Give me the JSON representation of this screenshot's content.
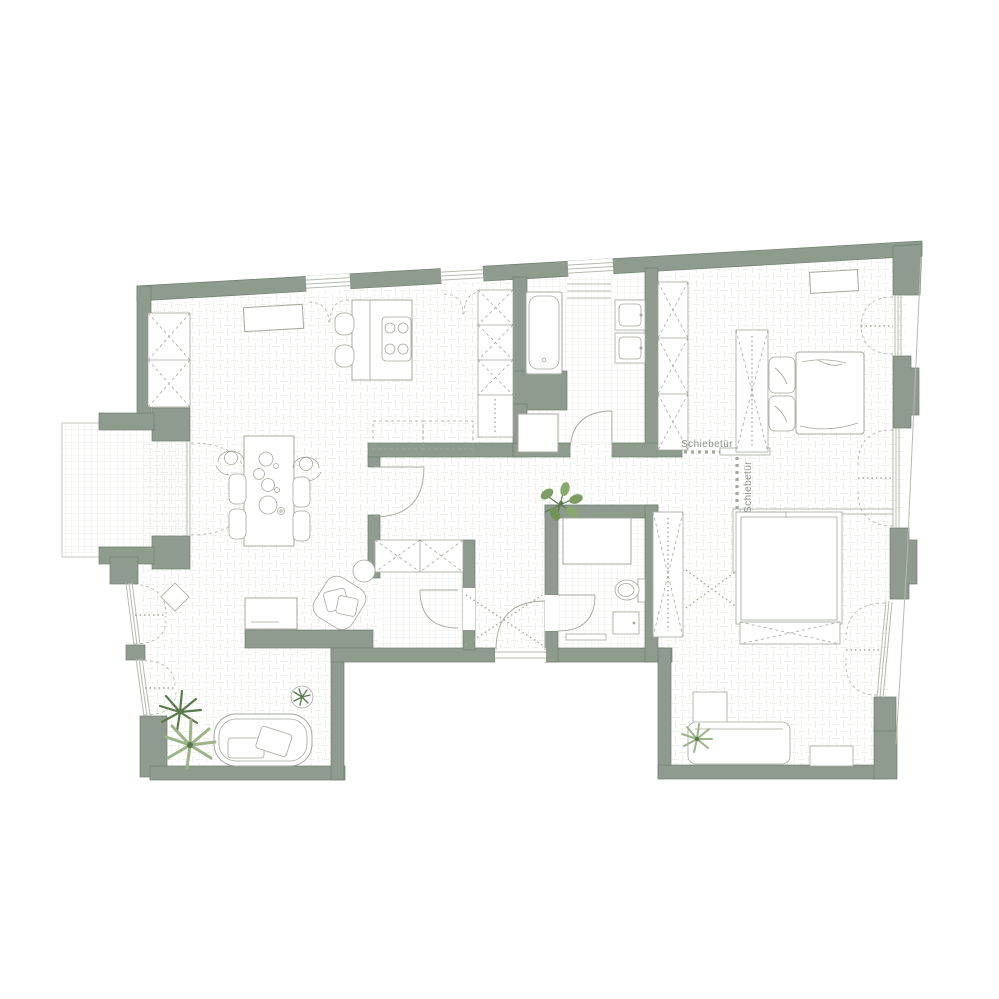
{
  "document": {
    "type": "architectural floor plan, top view, apartment with two bedrooms, two bathrooms, open kitchen-living area and balcony"
  },
  "labels": {
    "sliding_door_top": "Schiebetür",
    "sliding_door_right": "Schiebetür"
  },
  "colors": {
    "background": "#ffffff",
    "wall": "#8e9b8e",
    "wall_outline": "#6f7f6f",
    "line": "#a4a89c",
    "glass": "#b5bbae",
    "floor_pattern": "#edefe8",
    "grid_pattern": "#e7eae1",
    "plant_dark": "#5a7a4c",
    "plant_mid": "#7d9c63",
    "plant_light": "#9db388",
    "text": "#8d928a"
  }
}
